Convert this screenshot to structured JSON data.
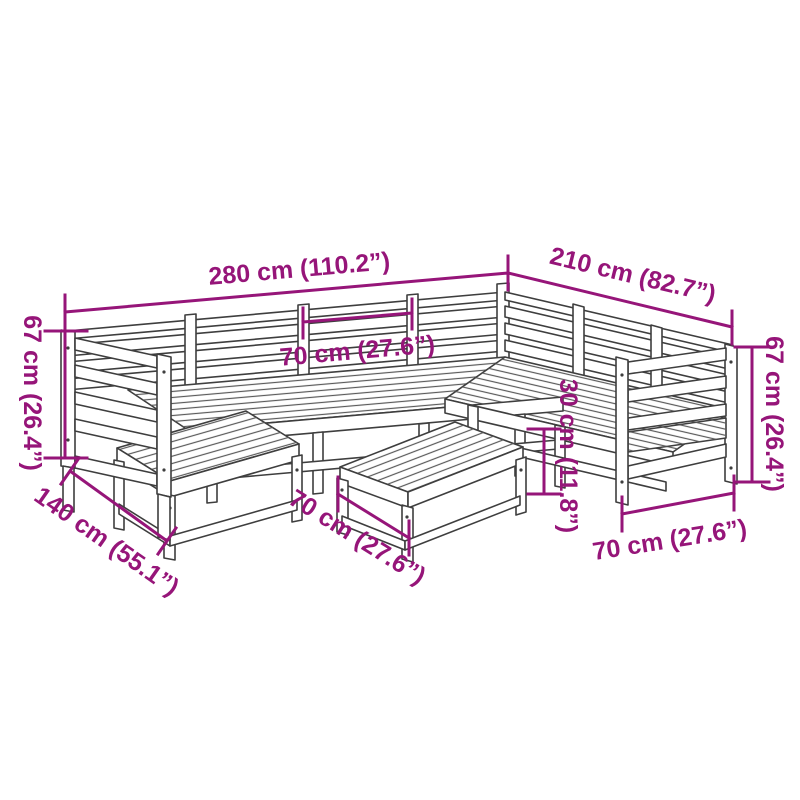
{
  "colors": {
    "dimension": "#961579",
    "artwork_line": "#3e3e3e"
  },
  "diagram": {
    "type": "furniture-dimension-diagram",
    "subject": "wooden garden corner sofa set with footstool and table, line drawing with measurements",
    "dimensions": {
      "total_width": "280 cm (110.2”)",
      "total_depth_right": "210 cm (82.7”)",
      "height_left": "67 cm (26.4”)",
      "height_right": "67 cm (26.4”)",
      "depth_left": "140 cm (55.1”)",
      "module_width": "70 cm (27.6”)",
      "footstool_width": "70 cm (27.6”)",
      "armchair_width": "70 cm (27.6”)",
      "seat_height": "30 cm (11.8”)"
    }
  }
}
